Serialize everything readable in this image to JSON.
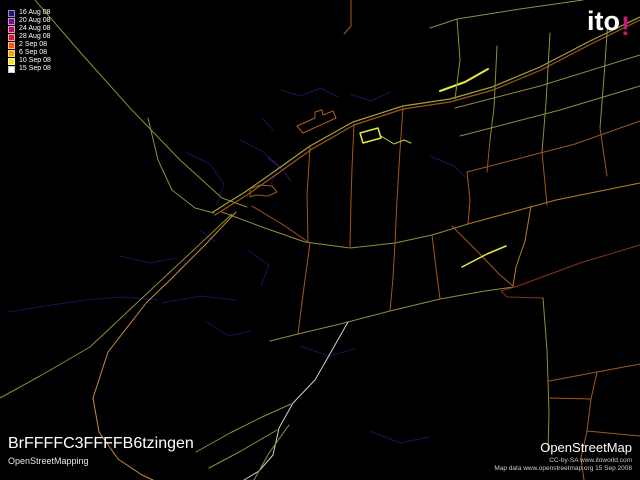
{
  "logo": {
    "text": "ito",
    "bang": "!",
    "bang_color": "#cc1576"
  },
  "legend": {
    "items": [
      {
        "label": "16 Aug 08",
        "fill": "#1c1c6e",
        "border": "#8f8fd0"
      },
      {
        "label": "20 Aug 08",
        "fill": "#6e1488",
        "border": "#cf8fdd"
      },
      {
        "label": "24 Aug 08",
        "fill": "#aa1166",
        "border": "#ee99bb"
      },
      {
        "label": "28 Aug 08",
        "fill": "#d01c30",
        "border": "#ff9f9f"
      },
      {
        "label": "2 Sep 08",
        "fill": "#e85c10",
        "border": "#ffbb88"
      },
      {
        "label": "6 Sep 08",
        "fill": "#eda313",
        "border": "#ffd98a"
      },
      {
        "label": "10 Sep 08",
        "fill": "#f5e329",
        "border": "#fff9a0"
      },
      {
        "label": "15 Sep 08",
        "fill": "#ffffff",
        "border": "#cccccc"
      }
    ]
  },
  "footer_left": {
    "title": "BrFFFFC3FFFFB6tzingen",
    "subtitle": "OpenStreetMapping"
  },
  "footer_right": {
    "title": "OpenStreetMap",
    "line1": "CC-by-SA www.itoworld.com",
    "line2": "Map data www.openstreetmap.org 15 Sep 2008"
  },
  "map": {
    "background": "#000000",
    "roads": [
      {
        "c": "#15155a",
        "w": 1,
        "p": "8,312 45,306 85,300 122,297 158,300"
      },
      {
        "c": "#15155a",
        "w": 1,
        "p": "162,303 200,296 236,300"
      },
      {
        "c": "#15155a",
        "w": 1,
        "p": "185,152 210,164 224,184 217,205"
      },
      {
        "c": "#15155a",
        "w": 1,
        "p": "240,140 262,151 279,166 270,186"
      },
      {
        "c": "#15155a",
        "w": 1,
        "p": "281,90 300,96 321,88 338,97"
      },
      {
        "c": "#15155a",
        "w": 1,
        "p": "350,94 371,101 390,92"
      },
      {
        "c": "#15155a",
        "w": 1,
        "p": "249,251 269,265 261,286"
      },
      {
        "c": "#15155a",
        "w": 1,
        "p": "300,346 329,356 355,349"
      },
      {
        "c": "#15155a",
        "w": 1,
        "p": "370,431 400,443 429,437"
      },
      {
        "c": "#15155a",
        "w": 1,
        "p": "430,156 454,166 470,181"
      },
      {
        "c": "#15155a",
        "w": 1,
        "p": "120,256 150,263 176,258"
      },
      {
        "c": "#15155a",
        "w": 1,
        "p": "205,321 229,336 250,331"
      },
      {
        "c": "#15155a",
        "w": 1,
        "p": "262,118 274,131"
      },
      {
        "c": "#15155a",
        "w": 1,
        "p": "200,230 216,242"
      },
      {
        "c": "#4a1060",
        "w": 1,
        "p": "268,158 282,169 291,181"
      },
      {
        "c": "#8f8f35",
        "w": 1,
        "p": "35,0 80,52 130,108 180,160 222,198 247,207"
      },
      {
        "c": "#8f8f35",
        "w": 1,
        "p": "148,118 158,160 172,190 195,208 214,213"
      },
      {
        "c": "#8f8f35",
        "w": 1,
        "p": "232,214 185,258 140,300 90,347 40,376 0,398"
      },
      {
        "c": "#c98a3a",
        "w": 1,
        "p": "236,212 205,245 168,282 147,302 108,352 93,398 99,432 118,459 142,475 153,480"
      },
      {
        "c": "#a2a23e",
        "w": 1.2,
        "p": "213,212 245,192 275,171 310,146 353,122 403,106 450,99 492,87 540,67 590,41 640,17"
      },
      {
        "c": "#9e5a16",
        "w": 1.2,
        "p": "215,215 247,195 277,174 312,149 354,125 403,109 450,102 493,90 541,70 591,44 640,20"
      },
      {
        "c": "#e9e93c",
        "w": 2,
        "p": "440,91 465,82 488,69"
      },
      {
        "c": "#a3571a",
        "w": 1,
        "p": "250,197 250,189 260,185 272,186 277,192 268,196 256,195 250,197"
      },
      {
        "c": "#8f8f3a",
        "w": 1,
        "p": "222,212 262,227 305,242 350,248 395,243 432,235 468,224"
      },
      {
        "c": "#a3571a",
        "w": 1,
        "p": "252,206 285,226 308,242"
      },
      {
        "c": "#a3571a",
        "w": 1,
        "p": "310,243 304,287 298,334"
      },
      {
        "c": "#8f8f3a",
        "w": 1,
        "p": "270,341 298,334 340,324 390,311 440,299 485,291 513,287"
      },
      {
        "c": "#cfcfcf",
        "w": 1,
        "p": "348,322 331,352 315,380 293,403 279,428 273,455 259,471 244,480"
      },
      {
        "c": "#8f8f3a",
        "w": 1,
        "p": "196,452 230,433 262,417 291,404"
      },
      {
        "c": "#8f8f3a",
        "w": 1,
        "p": "209,468 241,451 277,430"
      },
      {
        "c": "#8f8f3a",
        "w": 1,
        "p": "254,480 269,453 289,425"
      },
      {
        "c": "#8c3018",
        "w": 1,
        "p": "640,245 580,263 518,286 501,291 507,297 543,298"
      },
      {
        "c": "#8f8f3a",
        "w": 1,
        "p": "543,298 547,350 549,412 548,450"
      },
      {
        "c": "#b97c20",
        "w": 1,
        "p": "531,206 525,241 516,267 513,286"
      },
      {
        "c": "#a3571a",
        "w": 1,
        "p": "452,226 478,252 499,274 513,286"
      },
      {
        "c": "#e9e93c",
        "w": 1.5,
        "p": "462,267 487,254 506,246"
      },
      {
        "c": "#8f8f3a",
        "w": 1,
        "p": "455,108 540,86 640,55"
      },
      {
        "c": "#8f8f3a",
        "w": 1,
        "p": "460,136 560,110 640,86"
      },
      {
        "c": "#a3571a",
        "w": 1,
        "p": "467,172 575,144 640,121"
      },
      {
        "c": "#b97c20",
        "w": 1,
        "p": "468,224 556,200 640,183"
      },
      {
        "c": "#8f8f3a",
        "w": 1,
        "p": "457,19 460,60 455,99"
      },
      {
        "c": "#8f8f3a",
        "w": 1,
        "p": "497,46 494,108 490,140"
      },
      {
        "c": "#8f8f3a",
        "w": 1,
        "p": "550,33 546,103 542,152"
      },
      {
        "c": "#8f8f3a",
        "w": 1,
        "p": "608,20 604,77 600,128"
      },
      {
        "c": "#8f8f3a",
        "w": 1,
        "p": "430,28 457,19 520,9 583,0"
      },
      {
        "c": "#a3571a",
        "w": 1,
        "p": "490,140 487,172"
      },
      {
        "c": "#a3571a",
        "w": 1,
        "p": "542,152 547,205"
      },
      {
        "c": "#a3571a",
        "w": 1,
        "p": "600,128 607,176"
      },
      {
        "c": "#a3571a",
        "w": 1,
        "p": "310,147 307,195 308,242"
      },
      {
        "c": "#a3571a",
        "w": 1,
        "p": "354,124 352,168 351,200 350,248"
      },
      {
        "c": "#a3571a",
        "w": 1,
        "p": "403,108 400,150 397,200 395,243"
      },
      {
        "c": "#a3571a",
        "w": 1,
        "p": "395,243 393,278 390,311"
      },
      {
        "c": "#a3571a",
        "w": 1,
        "p": "432,235 436,268 440,299"
      },
      {
        "c": "#a3571a",
        "w": 1,
        "p": "467,172 470,200 468,224"
      },
      {
        "c": "#b06018",
        "w": 1,
        "p": "297,126 315,118 315,112 322,110 323,115 333,111 336,118 303,133 297,126"
      },
      {
        "c": "#e9e93c",
        "w": 1.5,
        "p": "360,133 378,128 381,138 363,143 360,133"
      },
      {
        "c": "#caca40",
        "w": 1,
        "p": "381,136 394,144 404,140 411,143"
      },
      {
        "c": "#a3571a",
        "w": 1,
        "p": "351,0 351,26 344,34"
      },
      {
        "c": "#a3571a",
        "w": 1,
        "p": "549,381 597,372 640,364"
      },
      {
        "c": "#a3571a",
        "w": 1,
        "p": "597,372 591,399"
      },
      {
        "c": "#a3571a",
        "w": 1,
        "p": "550,398 591,399"
      },
      {
        "c": "#a3571a",
        "w": 1,
        "p": "591,399 587,431"
      },
      {
        "c": "#a3571a",
        "w": 1,
        "p": "587,431 640,436"
      },
      {
        "c": "#a3571a",
        "w": 1,
        "p": "587,431 581,458 584,480"
      }
    ]
  }
}
